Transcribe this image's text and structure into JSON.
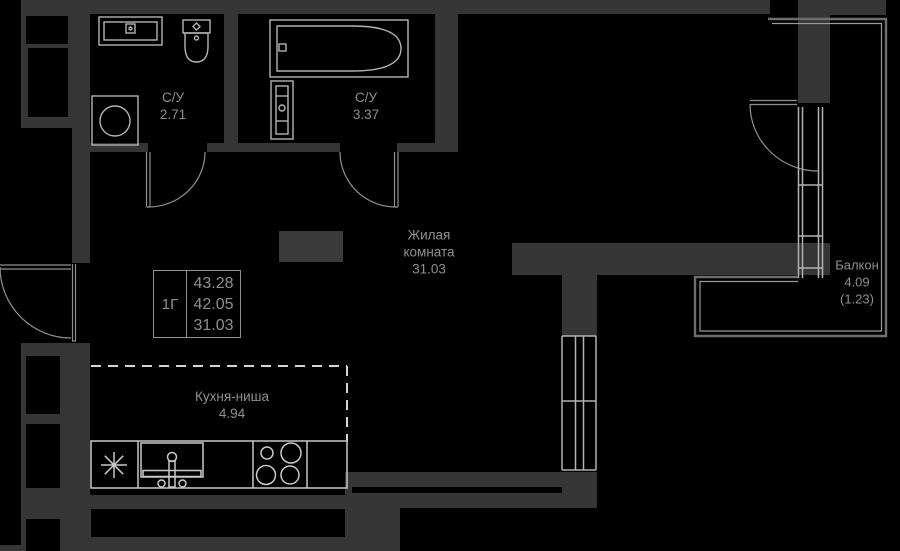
{
  "colors": {
    "bg": "#000000",
    "wall": "#353535",
    "shaft": "#3a3a3a",
    "fixture": "#b3b3b3",
    "door": "#8f8f8f",
    "counter": "#c9c9c9",
    "dash": "#d6d6d6",
    "balcony_outer": "#6e6e6e",
    "balcony_inner": "#9a9a9a",
    "text": "#8f8f8f",
    "table_border": "#8f8f8f"
  },
  "labels": {
    "bath1": {
      "name": "С/У",
      "area": "2.71"
    },
    "bath2": {
      "name": "С/У",
      "area": "3.37"
    },
    "living_room": {
      "line1": "Жилая",
      "line2": "комната",
      "area": "31.03"
    },
    "kitchen": {
      "name": "Кухня-ниша",
      "area": "4.94"
    },
    "balcony": {
      "name": "Балкон",
      "area": "4.09",
      "area_secondary": "(1.23)"
    }
  },
  "info_table": {
    "unit_type": "1Г",
    "values": [
      "43.28",
      "42.05",
      "31.03"
    ]
  }
}
